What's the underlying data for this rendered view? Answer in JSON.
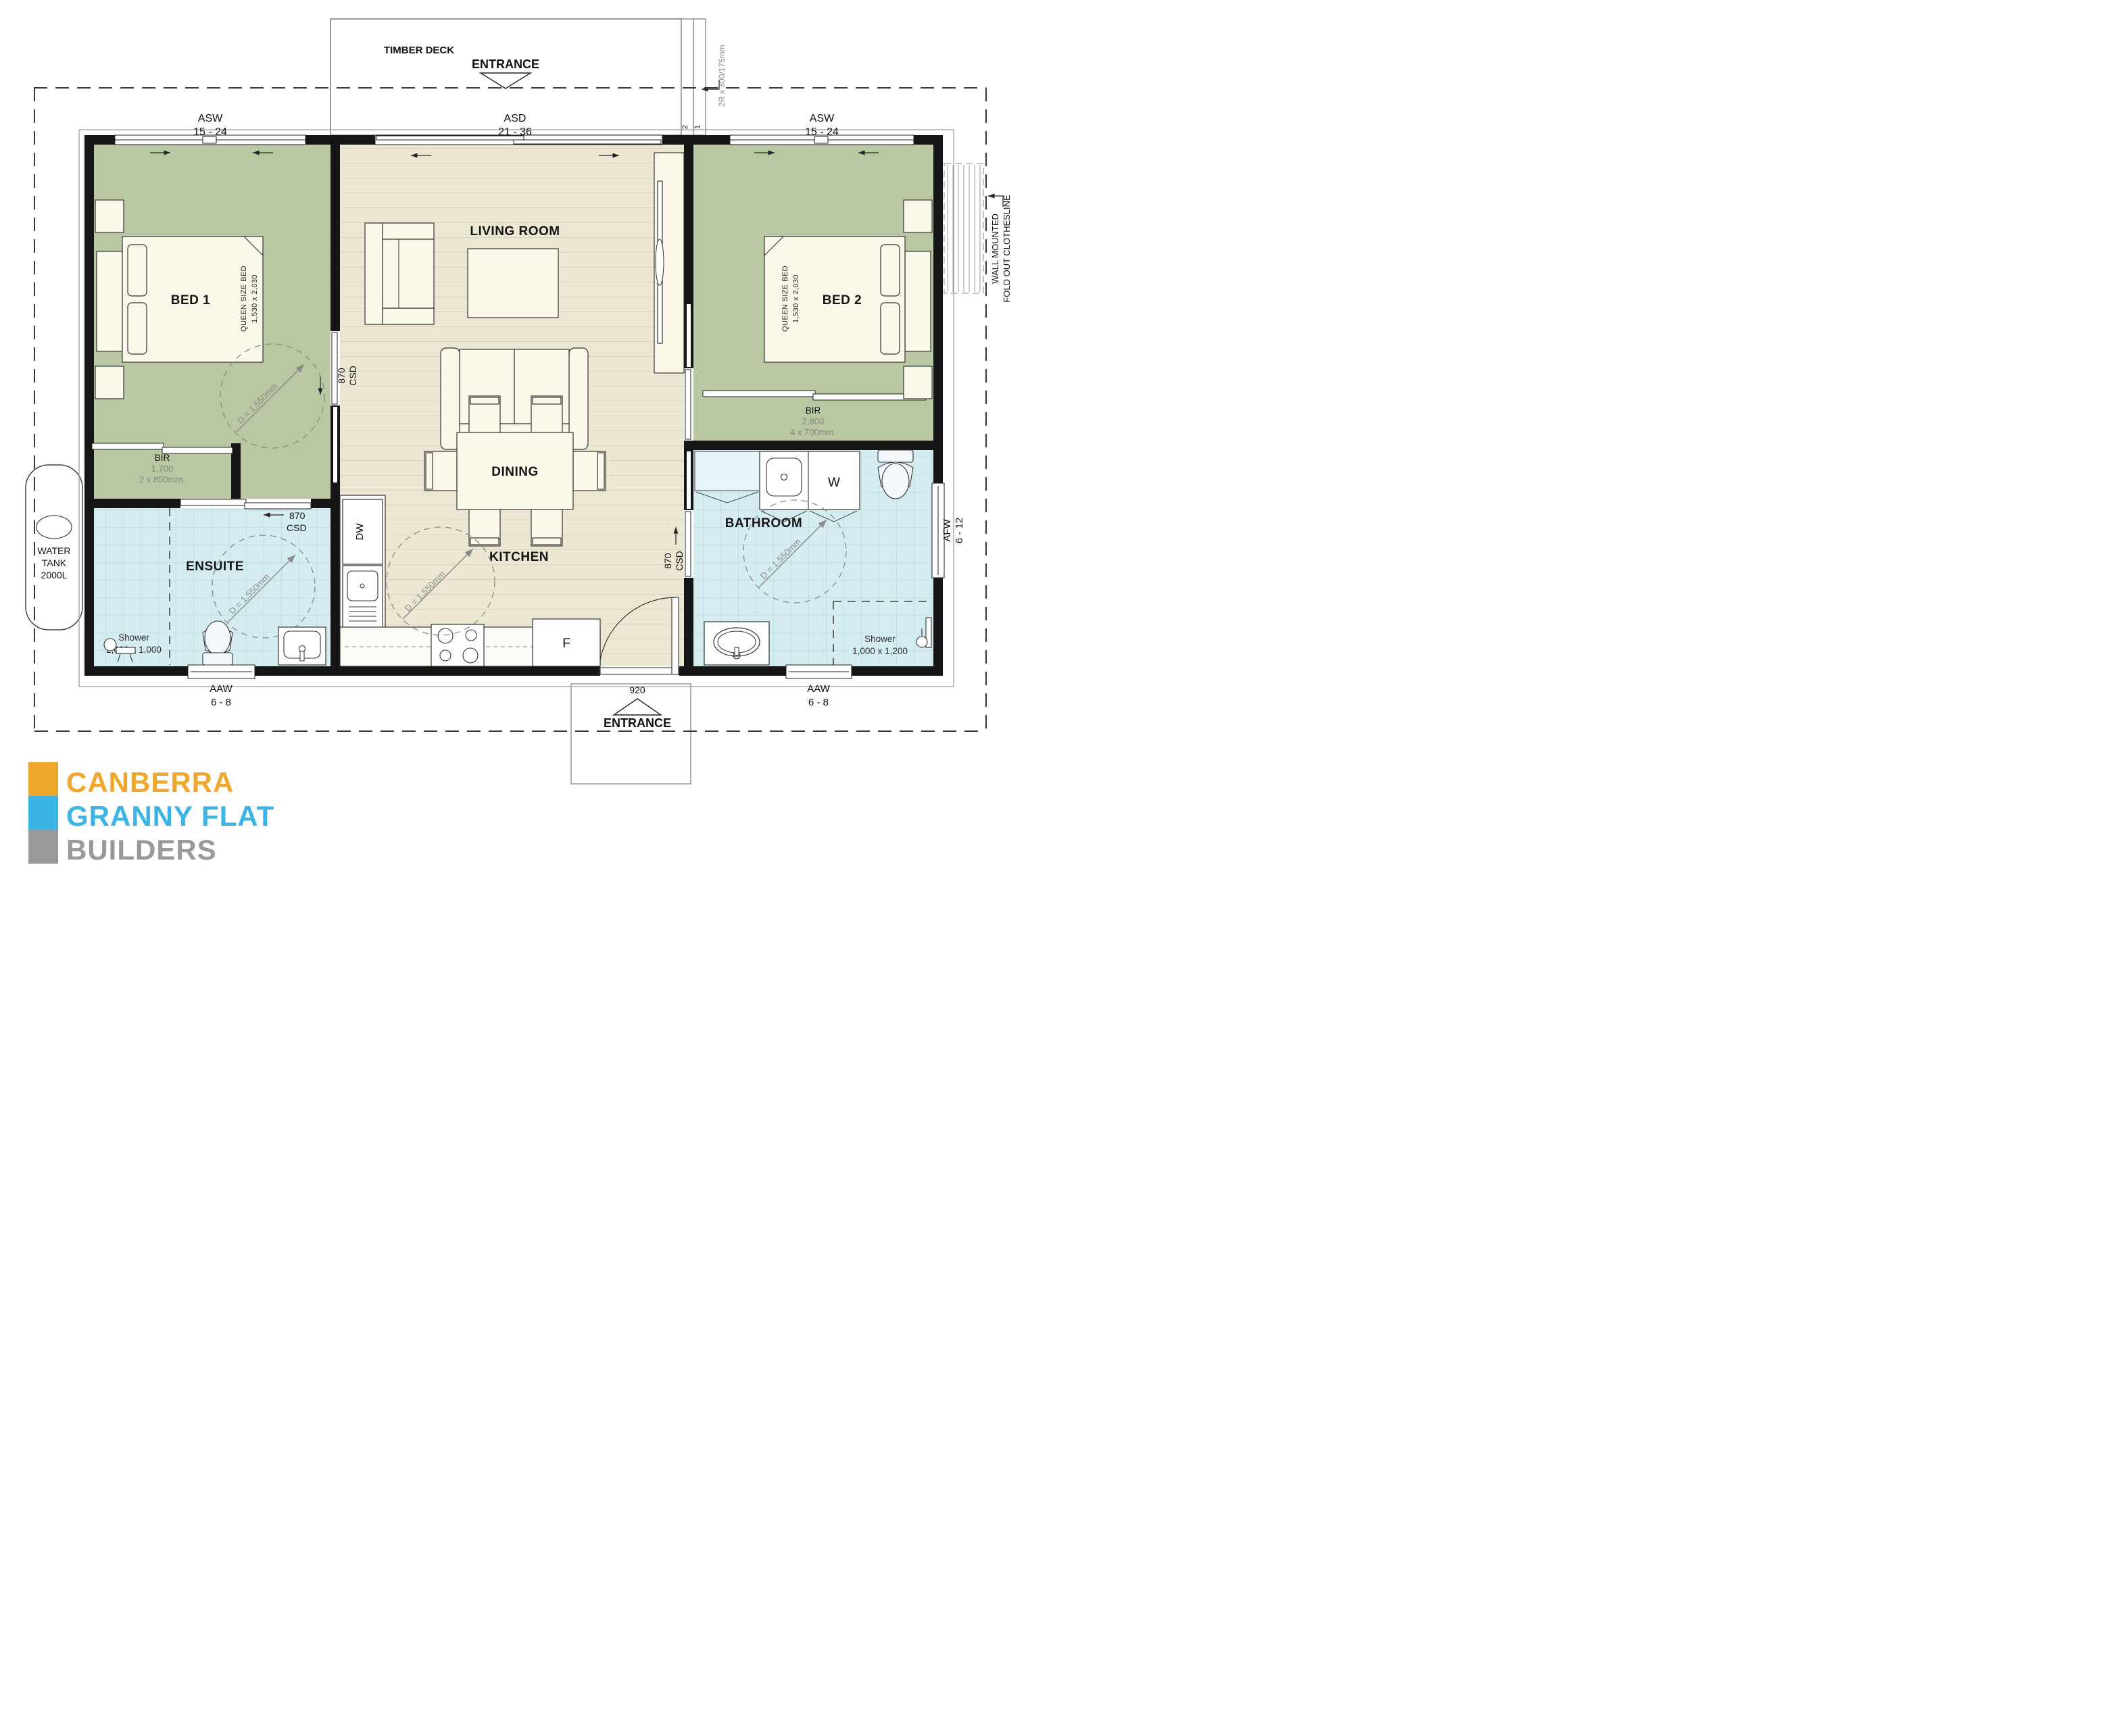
{
  "site": {
    "timber_deck": "TIMBER DECK",
    "entrance_top": "ENTRANCE",
    "entrance_bottom": "ENTRANCE",
    "entry_door_width": "920",
    "steps": {
      "riser_note": "2R x 300/175mm",
      "step2": "2",
      "step1": "1"
    },
    "water_tank": {
      "line1": "WATER",
      "line2": "TANK",
      "line3": "2000L"
    },
    "clothesline": {
      "line1": "WALL MOUNTED",
      "line2": "FOLD OUT CLOTHESLINE"
    }
  },
  "windows": {
    "asw_left": {
      "code": "ASW",
      "size": "15 - 24"
    },
    "asd_top": {
      "code": "ASD",
      "size": "21 - 36"
    },
    "asw_right": {
      "code": "ASW",
      "size": "15 - 24"
    },
    "aaw_left": {
      "code": "AAW",
      "size": "6 - 8"
    },
    "aaw_right": {
      "code": "AAW",
      "size": "6 - 8"
    },
    "afw_right": {
      "code": "AFW",
      "size": "6 - 12"
    }
  },
  "doors": {
    "csd_width": "870",
    "csd_type": "CSD"
  },
  "rooms": {
    "living": "LIVING ROOM",
    "dining": "DINING",
    "kitchen": "KITCHEN",
    "bed1": "BED 1",
    "bed2": "BED 2",
    "ensuite": "ENSUITE",
    "bathroom": "BATHROOM"
  },
  "fixtures": {
    "dishwasher": "DW",
    "fridge": "F",
    "washer": "W",
    "queen_bed_label": "QUEEN SIZE BED",
    "queen_bed_size": "1,530 x 2,030",
    "bir1": {
      "label": "BIR",
      "dim1": "1,700",
      "dim2": "2 x 850mm."
    },
    "bir2": {
      "label": "BIR",
      "dim1": "2,800",
      "dim2": "4 x 700mm."
    },
    "shower_ensuite": {
      "label": "Shower",
      "size": "2,000 x 1,000"
    },
    "shower_bathroom": {
      "label": "Shower",
      "size": "1,000 x 1,200"
    },
    "turning_circle": "D = 1,550mm"
  },
  "logo": {
    "line1": "CANBERRA",
    "line2": "GRANNY FLAT",
    "line3": "BUILDERS",
    "colors": {
      "orange": "#efa82d",
      "blue": "#3cb4e5",
      "gray": "#97999b"
    }
  }
}
